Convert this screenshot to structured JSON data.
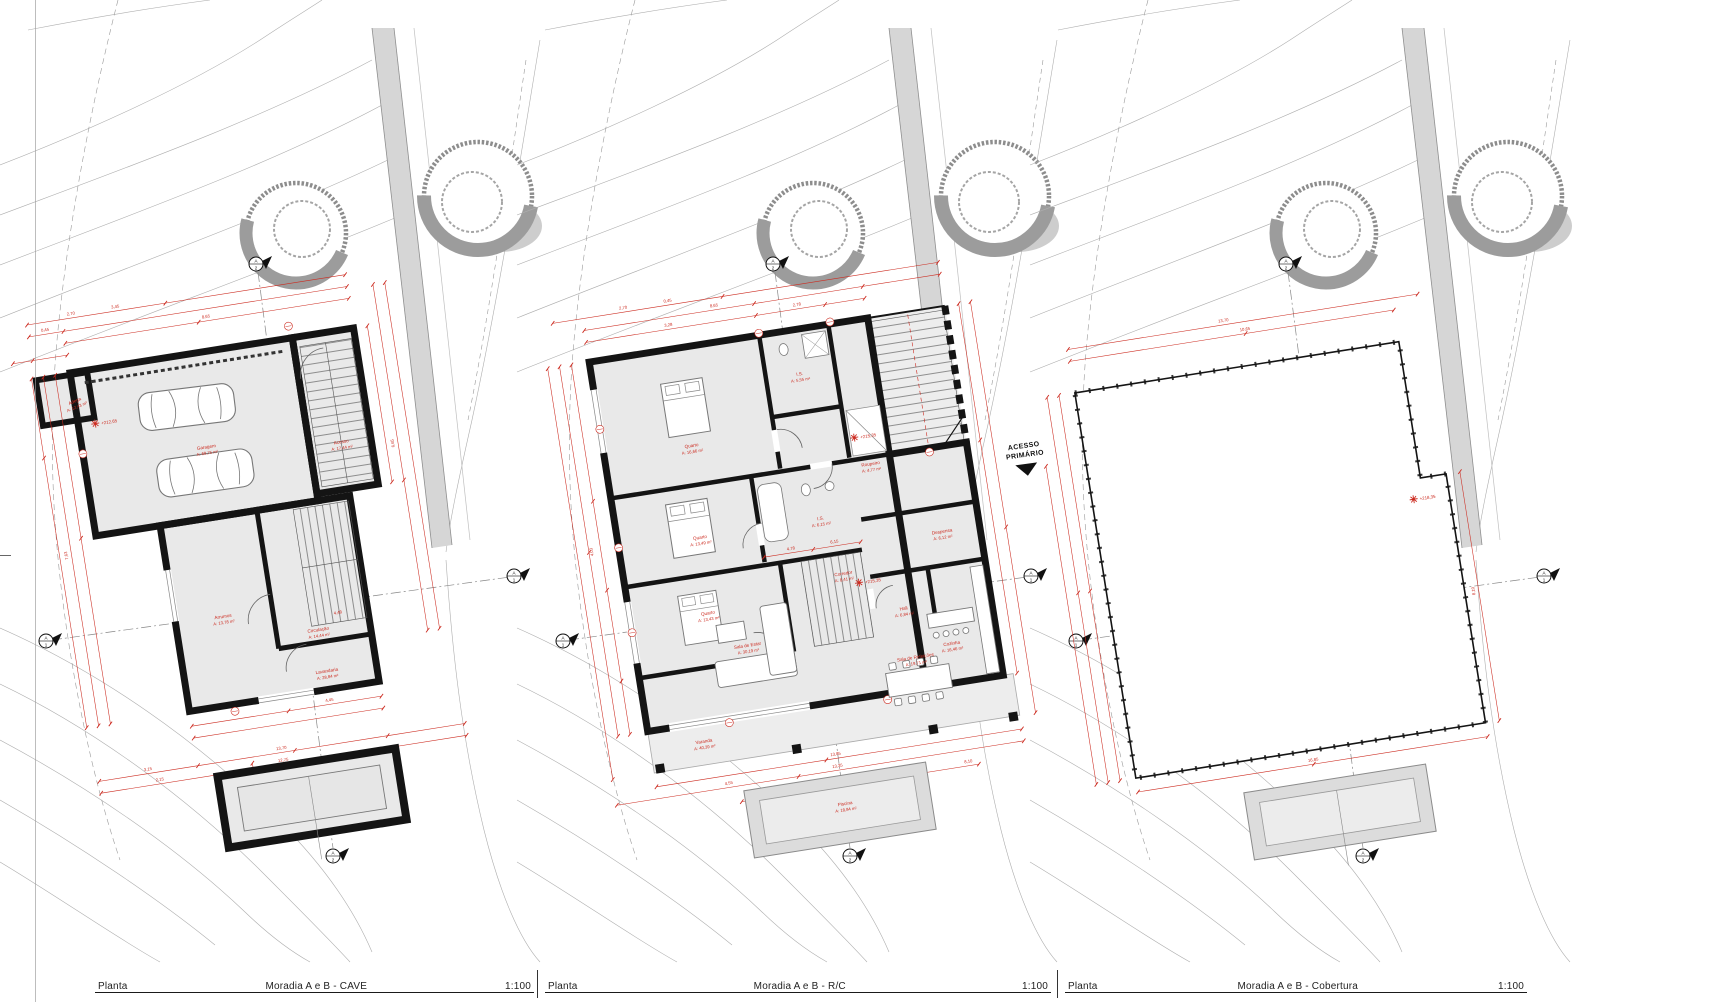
{
  "document": {
    "type": "architectural plan sheet",
    "accent_color": "#cc2a1f",
    "wall_color": "#141414",
    "floor_fill": "#e9e9e9"
  },
  "titleblocks": [
    {
      "label": "Planta",
      "drawing": "Moradia A e B - CAVE",
      "scale": "1:100"
    },
    {
      "label": "Planta",
      "drawing": "Moradia A e B - R/C",
      "scale": "1:100"
    },
    {
      "label": "Planta",
      "drawing": "Moradia A e B - Cobertura",
      "scale": "1:100"
    }
  ],
  "section_markers": {
    "letter": "A",
    "horizontal_number": "1",
    "vertical_number": "2"
  },
  "panels": [
    {
      "name": "CAVE",
      "level_marker": "+212,65",
      "rooms": [
        {
          "name": "Adega",
          "area": "A: 12,43 m²"
        },
        {
          "name": "Garagem",
          "area": "A: 69,75 m²"
        },
        {
          "name": "Acesso",
          "area": "A: 17,44 m²"
        },
        {
          "name": "Arrumos",
          "area": "A: 13,78 m²"
        },
        {
          "name": "Circulação",
          "area": "A: 14,44 m²"
        },
        {
          "name": "Lavandaria",
          "area": "A: 28,84 m²"
        }
      ],
      "dimensions": [
        "8,65",
        "3,45",
        "2,70",
        "0,45",
        "4,45",
        "7,63",
        "13,70",
        "12,75",
        "2,15",
        "3,15",
        "4,48",
        "6,65"
      ]
    },
    {
      "name": "R/C",
      "annotation": {
        "line1": "ACESSO",
        "line2": "PRIMÁRIO"
      },
      "level_markers": [
        "+215,35",
        "+215,35"
      ],
      "rooms": [
        {
          "name": "Quarto",
          "area": "A: 16,66 m²"
        },
        {
          "name": "I.S.",
          "area": "A: 5,55 m²"
        },
        {
          "name": "Roupeiro",
          "area": "A: 4,77 m²"
        },
        {
          "name": "Quarto",
          "area": "A: 13,49 m²"
        },
        {
          "name": "I.S.",
          "area": "A: 6,15 m²"
        },
        {
          "name": "Quarto",
          "area": "A: 13,43 m²"
        },
        {
          "name": "Corredor",
          "area": "A: 8,41 m²"
        },
        {
          "name": "Despensa",
          "area": "A: 6,12 m²"
        },
        {
          "name": "Hall",
          "area": "A: 6,84 m²"
        },
        {
          "name": "Cozinha",
          "area": "A: 16,46 m²"
        },
        {
          "name": "Sala de Estar",
          "area": "A: 30,19 m²"
        },
        {
          "name": "Sala de Refeições",
          "area": "A: 19,71 m²"
        },
        {
          "name": "Varanda",
          "area": "A: 40,39 m²"
        },
        {
          "name": "Piscina",
          "area": "A: 18,84 m²"
        }
      ],
      "dimensions": [
        "8,65",
        "2,70",
        "0,45",
        "2,78",
        "3,28",
        "4,78",
        "6,15",
        "13,85",
        "13,35",
        "16,85",
        "8,10",
        "1,45",
        "4,55",
        "4,03"
      ]
    },
    {
      "name": "Cobertura",
      "level_marker": "+218,35",
      "rooms": [],
      "dimensions": [
        "13,70",
        "10,65",
        "16,85",
        "8,10"
      ]
    }
  ]
}
